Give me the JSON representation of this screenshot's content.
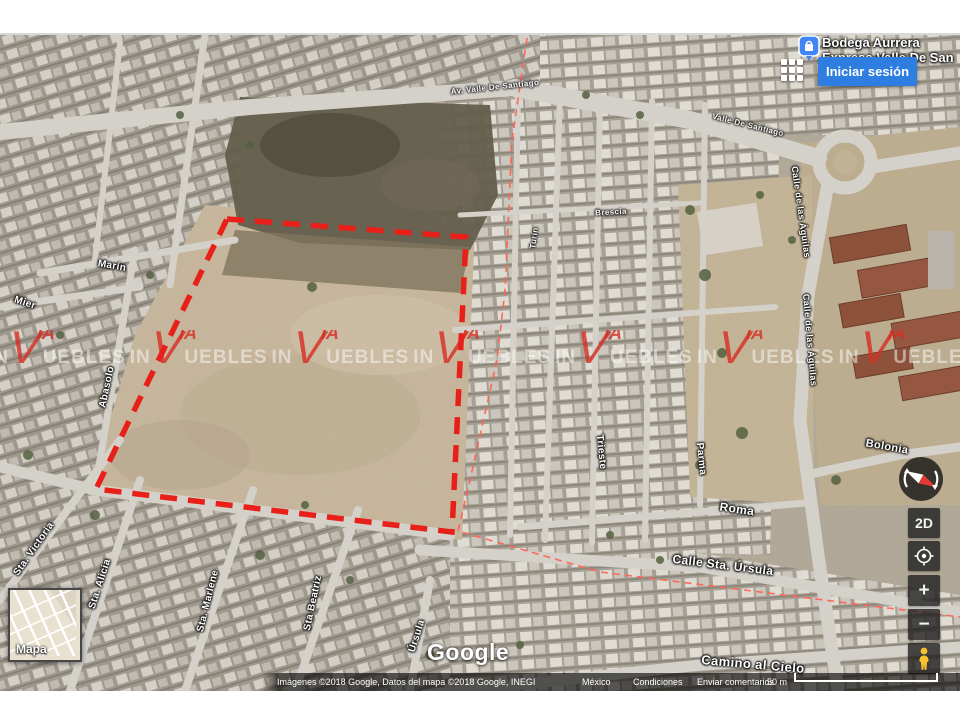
{
  "map_ui": {
    "place_label": {
      "line1": "Bodega Aurrera",
      "line2": "Express Valle De San"
    },
    "signin_button": "Iniciar sesión",
    "controls": {
      "view_toggle": "2D",
      "zoom_in": "+",
      "zoom_out": "−"
    },
    "minimap_label": "Mapa",
    "logo": "Google",
    "attribution": {
      "imagery": "Imágenes ©2018 Google, Datos del mapa ©2018 Google, INEGI",
      "region": "México",
      "terms": "Condiciones",
      "feedback": "Enviar comentarios",
      "scale_label": "50 m"
    }
  },
  "watermark": {
    "repeat": 8,
    "prefix": "IN",
    "logo_v": "V",
    "logo_ia": "IA",
    "suffix": "UEBLES"
  },
  "parcel": {
    "outline_color": "#e82019",
    "boundary_line_color": "#ff6352"
  },
  "colors": {
    "signin_blue": "#2e7de0",
    "place_icon_blue": "#4285f4",
    "pegman_yellow": "#fbc02d"
  },
  "street_labels": [
    {
      "text": "Mier",
      "x": 25,
      "y": 268,
      "rot": 18
    },
    {
      "text": "Marín",
      "x": 112,
      "y": 231,
      "rot": 10
    },
    {
      "text": "Abasolo",
      "x": 107,
      "y": 352,
      "rot": -78
    },
    {
      "text": "Sta. Victoria",
      "x": 34,
      "y": 514,
      "rot": -55
    },
    {
      "text": "Sta. Alicia",
      "x": 100,
      "y": 549,
      "rot": -72
    },
    {
      "text": "Sta. Marlene",
      "x": 208,
      "y": 566,
      "rot": -76
    },
    {
      "text": "Sta Beatriz",
      "x": 313,
      "y": 568,
      "rot": -78
    },
    {
      "text": "Úrsula",
      "x": 417,
      "y": 601,
      "rot": -72
    },
    {
      "text": "Turín",
      "x": 534,
      "y": 203,
      "rot": -82,
      "size": 8,
      "opacity": 0.9
    },
    {
      "text": "Brescia",
      "x": 611,
      "y": 177,
      "rot": -3,
      "size": 8,
      "opacity": 0.9
    },
    {
      "text": "Trieste",
      "x": 601,
      "y": 417,
      "rot": 84
    },
    {
      "text": "Parma",
      "x": 701,
      "y": 424,
      "rot": 84
    },
    {
      "text": "Roma",
      "x": 737,
      "y": 474,
      "rot": 8,
      "size": 12
    },
    {
      "text": "Bolonia",
      "x": 887,
      "y": 412,
      "rot": 10,
      "size": 11
    },
    {
      "text": "Calle Sta. Úrsula",
      "x": 723,
      "y": 530,
      "rot": 7,
      "size": 12
    },
    {
      "text": "Camino al Cielo",
      "x": 753,
      "y": 629,
      "rot": 5,
      "size": 13
    },
    {
      "text": "Calle de las Águilas",
      "x": 801,
      "y": 177,
      "rot": 82,
      "size": 9
    },
    {
      "text": "Calle de las Águilas",
      "x": 810,
      "y": 305,
      "rot": 85,
      "size": 9
    },
    {
      "text": "Av. Valle De Santiago",
      "x": 495,
      "y": 52,
      "rot": -6,
      "size": 8,
      "opacity": 0.85
    },
    {
      "text": "Valle De Santiago",
      "x": 748,
      "y": 90,
      "rot": 14,
      "size": 8,
      "opacity": 0.85
    }
  ]
}
